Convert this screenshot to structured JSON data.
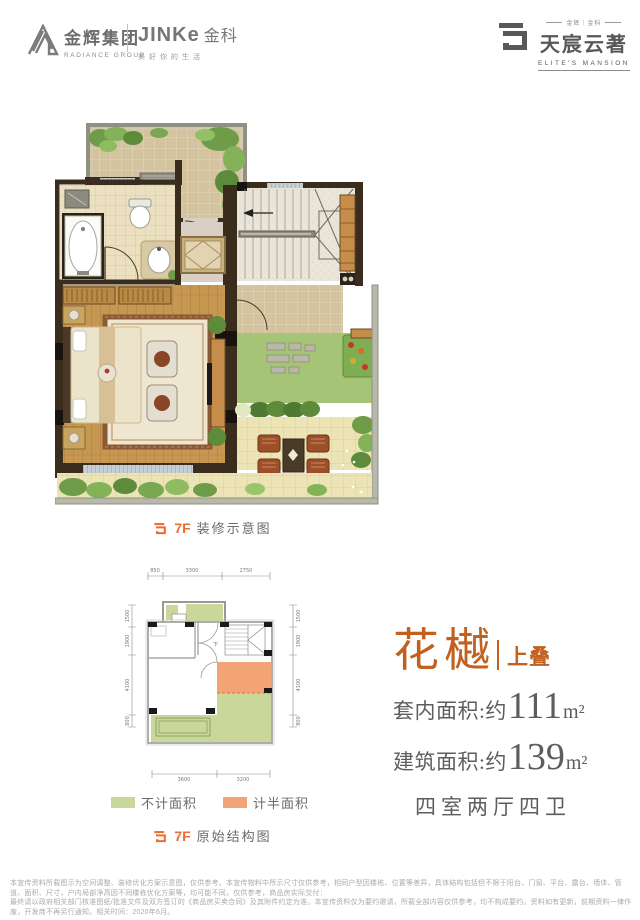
{
  "header": {
    "radiance_cn": "金辉集团",
    "radiance_en": "RADIANCE GROUP",
    "jinke_en": "JINKe",
    "jinke_cn": "金科",
    "jinke_slogan": "美好你的生活",
    "brand_small": "金辉｜金科",
    "brand_cn": "天宸云著",
    "brand_en": "ELITE'S MANSION"
  },
  "decor_plan": {
    "floor": "7F",
    "caption": "装修示意图"
  },
  "structure_plan": {
    "floor": "7F",
    "caption": "原始结构图",
    "stair_label": "下",
    "dims_top": [
      "850",
      "3300",
      "2750"
    ],
    "dims_left": [
      "1500",
      "1900",
      "4100",
      "800"
    ],
    "dims_right": [
      "1500",
      "1900",
      "4100",
      "800"
    ],
    "dims_bottom": [
      "3600",
      "3200"
    ],
    "legend": [
      {
        "label": "不计面积",
        "color": "#c9d79b"
      },
      {
        "label": "计半面积",
        "color": "#f2a477"
      }
    ]
  },
  "info": {
    "name": "花樾",
    "tier": "上叠",
    "area_inner_label": "套内面积:约",
    "area_inner_value": "111",
    "area_gross_label": "建筑面积:约",
    "area_gross_value": "139",
    "area_unit": "m²",
    "rooms": "四室两厅四卫"
  },
  "colors": {
    "accent_orange": "#ec6c30",
    "headline_orange": "#c2601f",
    "text_gray": "#5f5c5c",
    "legend_green": "#c9d79b",
    "legend_orange": "#f2a477",
    "wall_brown": "#3b2d1d",
    "wood_floor": "#c69750",
    "tile_beige": "#d3c39e",
    "paving_yellow": "#ece4b5",
    "lawn_green": "#a6c475"
  },
  "disclaimer": {
    "line1": "本宣传资料所载图示为空间调整、装修优化方案示意图，仅供参考。本宣传物料中所示尺寸仅供参考，相同户型因楼栋、位置等差异，具体结构包括但不限于阳台、门窗、平台、露台、墙体、管道、面积、尺寸，户内局部净高因不同楼栋优化方案等，均可能不同，仅供参考，商品房实际交付：",
    "line2": "最终请以政府相关部门核准图纸/批准文件及双方签订的《商品房买卖合同》及其附件约定为准。本宣传资料仅为要约邀请，所载全部内容仅供参考，均不构成要约。资料如有更新，前期资料一律作废，开发商不再另行通知。相关时间：2020年6月。"
  }
}
